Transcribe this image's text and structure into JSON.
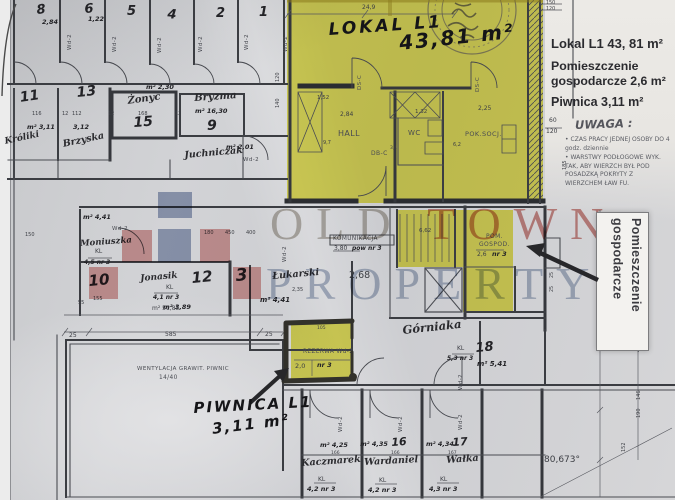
{
  "colors": {
    "highlight_yellow": "#e7e23a",
    "logo_blue": "#8696b6",
    "logo_pink": "#d98e8c",
    "watermark_red": "#b0352b",
    "watermark_blue": "#7688a8",
    "marker_black": "#151518"
  },
  "watermark": {
    "old": "OLD",
    "town": "TOWN",
    "property": "PROPERTY"
  },
  "right_panel": {
    "title": "Lokal L1 43, 81 m²",
    "line2": "Pomieszczenie",
    "line3": "gospodarcze 2,6 m²",
    "line4": "Piwnica 3,11 m²",
    "uwaga": "UWAGA :",
    "note1": "CZAS PRACY JEDNEJ OSOBY DO 4 godz. dziennie",
    "note2": "WARSTWY PODŁOGOWE WYK. TAK, ABY WIERZCH BYŁ POD POSADZKĄ POKRYTY Z WIERZCHEM ŁAW FU."
  },
  "rotated_label": {
    "line1": "Pomieszczenie",
    "line2": "gospodarcze"
  },
  "marker_notes": {
    "lokal": "LOKAL L1",
    "lokal_area": "43,81 m²",
    "piwnica": "PIWNICA L1",
    "piwnica_area": "3,11 m²"
  },
  "highlights": [
    {
      "x": 287,
      "y": 0,
      "w": 256,
      "h": 203
    },
    {
      "x": 397,
      "y": 210,
      "w": 116,
      "h": 57
    },
    {
      "x": 463,
      "y": 267,
      "w": 50,
      "h": 45
    },
    {
      "x": 291,
      "y": 323,
      "w": 61,
      "h": 57
    }
  ],
  "logo_squares": [
    {
      "x": 158,
      "y": 192,
      "w": 34,
      "h": 26,
      "c": "#8696b6"
    },
    {
      "x": 158,
      "y": 229,
      "w": 33,
      "h": 33,
      "c": "#8696b6"
    },
    {
      "x": 122,
      "y": 230,
      "w": 30,
      "h": 32,
      "c": "#d98e8c"
    },
    {
      "x": 200,
      "y": 229,
      "w": 30,
      "h": 33,
      "c": "#d98e8c"
    },
    {
      "x": 89,
      "y": 267,
      "w": 29,
      "h": 32,
      "c": "#d98e8c"
    },
    {
      "x": 233,
      "y": 267,
      "w": 28,
      "h": 32,
      "c": "#d98e8c"
    }
  ],
  "plan_labels": [
    {
      "t": "8",
      "x": 36,
      "y": 4,
      "s": 13,
      "st": "pen",
      "r": -6
    },
    {
      "t": "2,84",
      "x": 42,
      "y": 19,
      "s": 6.5,
      "st": "pen"
    },
    {
      "t": "6",
      "x": 84,
      "y": 3,
      "s": 13,
      "st": "pen",
      "r": -4
    },
    {
      "t": "1,22",
      "x": 88,
      "y": 16,
      "s": 6.5,
      "st": "pen"
    },
    {
      "t": "5",
      "x": 127,
      "y": 5,
      "s": 13,
      "st": "pen"
    },
    {
      "t": "4",
      "x": 168,
      "y": 8,
      "s": 13,
      "st": "pen",
      "r": 5
    },
    {
      "t": "2",
      "x": 216,
      "y": 7,
      "s": 13,
      "st": "pen"
    },
    {
      "t": "1",
      "x": 259,
      "y": 6,
      "s": 13,
      "st": "pen"
    },
    {
      "t": "Wd-2",
      "x": 68,
      "y": 50,
      "s": 5.5,
      "st": "tech",
      "r": -90
    },
    {
      "t": "Wd-2",
      "x": 113,
      "y": 52,
      "s": 5.5,
      "st": "tech",
      "r": -90
    },
    {
      "t": "Wd-2",
      "x": 158,
      "y": 53,
      "s": 5.5,
      "st": "tech",
      "r": -90
    },
    {
      "t": "Wd-2",
      "x": 199,
      "y": 52,
      "s": 5.5,
      "st": "tech",
      "r": -90
    },
    {
      "t": "Wd-2",
      "x": 245,
      "y": 50,
      "s": 5.5,
      "st": "tech",
      "r": -90
    },
    {
      "t": "Wd-2",
      "x": 284,
      "y": 52,
      "s": 5.5,
      "st": "tech",
      "r": -90
    },
    {
      "t": "120",
      "x": 276,
      "y": 82,
      "s": 5,
      "st": "print",
      "r": -90
    },
    {
      "t": "140",
      "x": 276,
      "y": 108,
      "s": 5,
      "st": "print",
      "r": -90
    },
    {
      "t": "11",
      "x": 19,
      "y": 91,
      "s": 14,
      "st": "pen",
      "r": -8
    },
    {
      "t": "13",
      "x": 76,
      "y": 86,
      "s": 14,
      "st": "pen",
      "r": -6
    },
    {
      "t": "m² 2,30",
      "x": 146,
      "y": 84,
      "s": 6.5,
      "st": "pen"
    },
    {
      "t": "Żonyc",
      "x": 127,
      "y": 97,
      "s": 10,
      "st": "cursive",
      "r": -8
    },
    {
      "t": "15",
      "x": 133,
      "y": 116,
      "s": 14,
      "st": "pen",
      "r": -4
    },
    {
      "t": "Bryzma",
      "x": 194,
      "y": 94,
      "s": 10,
      "st": "cursive",
      "r": -4
    },
    {
      "t": "m² 16,30",
      "x": 195,
      "y": 108,
      "s": 6.5,
      "st": "pen"
    },
    {
      "t": "9",
      "x": 207,
      "y": 119,
      "s": 14,
      "st": "pen"
    },
    {
      "t": "116",
      "x": 32,
      "y": 112,
      "s": 5,
      "st": "print"
    },
    {
      "t": "12",
      "x": 62,
      "y": 112,
      "s": 5,
      "st": "print"
    },
    {
      "t": "112",
      "x": 72,
      "y": 112,
      "s": 5,
      "st": "print"
    },
    {
      "t": "12",
      "x": 108,
      "y": 112,
      "s": 5,
      "st": "print"
    },
    {
      "t": "168",
      "x": 138,
      "y": 112,
      "s": 5,
      "st": "print"
    },
    {
      "t": "12",
      "x": 175,
      "y": 112,
      "s": 5,
      "st": "print"
    },
    {
      "t": "m² 3,11",
      "x": 27,
      "y": 124,
      "s": 6.5,
      "st": "pen"
    },
    {
      "t": "3,12",
      "x": 73,
      "y": 124,
      "s": 6.5,
      "st": "pen"
    },
    {
      "t": "Króliki",
      "x": 4,
      "y": 138,
      "s": 9,
      "st": "cursive",
      "r": -12
    },
    {
      "t": "Brzyska",
      "x": 62,
      "y": 140,
      "s": 9.5,
      "st": "cursive",
      "r": -12
    },
    {
      "t": "Juchniczak",
      "x": 184,
      "y": 151,
      "s": 9.5,
      "st": "cursive",
      "r": -5
    },
    {
      "t": "m² 2,01",
      "x": 226,
      "y": 144,
      "s": 6.5,
      "st": "pen"
    },
    {
      "t": "Wd-2",
      "x": 243,
      "y": 158,
      "s": 5.5,
      "st": "tech"
    },
    {
      "t": "24,9",
      "x": 362,
      "y": 5,
      "s": 6,
      "st": "print"
    },
    {
      "t": "HALL",
      "x": 338,
      "y": 130,
      "s": 8,
      "st": "tech"
    },
    {
      "t": "WC",
      "x": 408,
      "y": 130,
      "s": 7,
      "st": "tech"
    },
    {
      "t": "POK.SOCJ.",
      "x": 465,
      "y": 131,
      "s": 6.5,
      "st": "tech"
    },
    {
      "t": "DS-C",
      "x": 358,
      "y": 90,
      "s": 5.5,
      "st": "tech",
      "r": -90
    },
    {
      "t": "DS-C",
      "x": 476,
      "y": 92,
      "s": 5.5,
      "st": "tech",
      "r": -90
    },
    {
      "t": "DB-C",
      "x": 371,
      "y": 151,
      "s": 6,
      "st": "tech"
    },
    {
      "t": "3,4",
      "x": 390,
      "y": 147,
      "s": 4.5,
      "st": "print"
    },
    {
      "t": "1,52",
      "x": 317,
      "y": 96,
      "s": 5.5,
      "st": "print"
    },
    {
      "t": "2,84",
      "x": 340,
      "y": 112,
      "s": 6,
      "st": "print"
    },
    {
      "t": "1,32",
      "x": 415,
      "y": 110,
      "s": 5.5,
      "st": "print"
    },
    {
      "t": "2,25",
      "x": 478,
      "y": 106,
      "s": 6,
      "st": "print"
    },
    {
      "t": "9,7",
      "x": 323,
      "y": 141,
      "s": 5,
      "st": "print"
    },
    {
      "t": "6,2",
      "x": 453,
      "y": 143,
      "s": 5,
      "st": "print"
    },
    {
      "t": "KOMUNIKACJA",
      "x": 333,
      "y": 237,
      "s": 5.8,
      "st": "tech"
    },
    {
      "t": "3,80",
      "x": 334,
      "y": 246,
      "s": 6,
      "st": "print"
    },
    {
      "t": "pow nr 3",
      "x": 352,
      "y": 246,
      "s": 6,
      "st": "pen"
    },
    {
      "t": "2,68",
      "x": 349,
      "y": 271,
      "s": 9.5,
      "st": "print"
    },
    {
      "t": "6,62",
      "x": 419,
      "y": 229,
      "s": 5.5,
      "st": "print"
    },
    {
      "t": "POM.",
      "x": 486,
      "y": 234,
      "s": 6,
      "st": "tech"
    },
    {
      "t": "GOSPOD.",
      "x": 479,
      "y": 242,
      "s": 6,
      "st": "tech"
    },
    {
      "t": "2,6",
      "x": 477,
      "y": 252,
      "s": 6,
      "st": "print"
    },
    {
      "t": "nr 3",
      "x": 492,
      "y": 251,
      "s": 6.5,
      "st": "pen"
    },
    {
      "t": "Wd-2",
      "x": 283,
      "y": 262,
      "s": 5.5,
      "st": "tech",
      "r": -90
    },
    {
      "t": "180",
      "x": 204,
      "y": 231,
      "s": 5,
      "st": "print"
    },
    {
      "t": "450",
      "x": 225,
      "y": 231,
      "s": 5,
      "st": "print"
    },
    {
      "t": "400",
      "x": 246,
      "y": 231,
      "s": 5,
      "st": "print"
    },
    {
      "t": "m² 4,41",
      "x": 83,
      "y": 214,
      "s": 6.5,
      "st": "pen"
    },
    {
      "t": "Wd-2",
      "x": 112,
      "y": 227,
      "s": 5.5,
      "st": "tech"
    },
    {
      "t": "Moniuszka",
      "x": 80,
      "y": 240,
      "s": 8.5,
      "st": "cursive",
      "r": -4
    },
    {
      "t": "KL",
      "x": 95,
      "y": 249,
      "s": 6,
      "st": "print"
    },
    {
      "t": "4,5 nr 3",
      "x": 84,
      "y": 260,
      "s": 6,
      "st": "pen"
    },
    {
      "t": "10",
      "x": 88,
      "y": 274,
      "s": 15,
      "st": "pen",
      "r": -5
    },
    {
      "t": "155",
      "x": 93,
      "y": 297,
      "s": 5,
      "st": "print"
    },
    {
      "t": "55",
      "x": 78,
      "y": 301,
      "s": 5,
      "st": "print"
    },
    {
      "t": "150",
      "x": 25,
      "y": 233,
      "s": 5,
      "st": "print"
    },
    {
      "t": "12",
      "x": 191,
      "y": 271,
      "s": 15,
      "st": "pen",
      "r": -5
    },
    {
      "t": "Jonasik",
      "x": 140,
      "y": 275,
      "s": 9,
      "st": "cursive",
      "r": -5
    },
    {
      "t": "Łukarski",
      "x": 272,
      "y": 272,
      "s": 9.5,
      "st": "cursive",
      "r": -5
    },
    {
      "t": "3",
      "x": 235,
      "y": 268,
      "s": 17,
      "st": "pen",
      "r": -5
    },
    {
      "t": "KL",
      "x": 166,
      "y": 285,
      "s": 6,
      "st": "print"
    },
    {
      "t": "4,1 nr 3",
      "x": 153,
      "y": 295,
      "s": 6,
      "st": "pen"
    },
    {
      "t": "m² 3,89",
      "x": 163,
      "y": 304,
      "s": 6.5,
      "st": "pen"
    },
    {
      "t": "m² 4,41",
      "x": 260,
      "y": 297,
      "s": 7,
      "st": "pen"
    },
    {
      "t": "2,35",
      "x": 292,
      "y": 288,
      "s": 5,
      "st": "print"
    },
    {
      "t": "m² 51,85",
      "x": 152,
      "y": 306,
      "s": 6,
      "st": "print"
    },
    {
      "t": "25",
      "x": 69,
      "y": 333,
      "s": 6,
      "st": "print"
    },
    {
      "t": "585",
      "x": 165,
      "y": 332,
      "s": 6,
      "st": "print"
    },
    {
      "t": "25",
      "x": 265,
      "y": 332,
      "s": 6,
      "st": "print"
    },
    {
      "t": "WENTYLACJA GRAWIT. PIWNIC",
      "x": 137,
      "y": 367,
      "s": 5.5,
      "st": "tech"
    },
    {
      "t": "14/40",
      "x": 159,
      "y": 376,
      "s": 5.8,
      "st": "tech"
    },
    {
      "t": "105",
      "x": 317,
      "y": 327,
      "s": 4.5,
      "st": "print"
    },
    {
      "t": "REZERWA Wd-2",
      "x": 303,
      "y": 350,
      "s": 5.8,
      "st": "tech"
    },
    {
      "t": "2,0",
      "x": 295,
      "y": 363,
      "s": 6.5,
      "st": "print"
    },
    {
      "t": "nr 3",
      "x": 317,
      "y": 362,
      "s": 6.5,
      "st": "pen"
    },
    {
      "t": "Górniaka",
      "x": 402,
      "y": 325,
      "s": 11.5,
      "st": "cursive",
      "r": -6
    },
    {
      "t": "KL",
      "x": 457,
      "y": 346,
      "s": 6,
      "st": "print"
    },
    {
      "t": "5,3 nr 3",
      "x": 447,
      "y": 356,
      "s": 6,
      "st": "pen"
    },
    {
      "t": "18",
      "x": 475,
      "y": 342,
      "s": 13,
      "st": "pen",
      "r": -5
    },
    {
      "t": "m² 5,41",
      "x": 477,
      "y": 361,
      "s": 7,
      "st": "pen"
    },
    {
      "t": "Wd-2",
      "x": 459,
      "y": 390,
      "s": 5.5,
      "st": "tech",
      "r": -90
    },
    {
      "t": "m² 4,25",
      "x": 320,
      "y": 442,
      "s": 6.5,
      "st": "pen"
    },
    {
      "t": "m² 4,35",
      "x": 360,
      "y": 441,
      "s": 6.5,
      "st": "pen"
    },
    {
      "t": "16",
      "x": 391,
      "y": 437,
      "s": 11,
      "st": "pen",
      "r": -4
    },
    {
      "t": "m² 4,34",
      "x": 426,
      "y": 441,
      "s": 6.5,
      "st": "pen"
    },
    {
      "t": "17",
      "x": 452,
      "y": 437,
      "s": 11,
      "st": "pen",
      "r": -4
    },
    {
      "t": "166",
      "x": 331,
      "y": 452,
      "s": 4.5,
      "st": "print"
    },
    {
      "t": "166",
      "x": 391,
      "y": 452,
      "s": 4.5,
      "st": "print"
    },
    {
      "t": "167",
      "x": 448,
      "y": 452,
      "s": 4.5,
      "st": "print"
    },
    {
      "t": "Kaczmarek",
      "x": 301,
      "y": 459,
      "s": 9.5,
      "st": "cursive",
      "r": -4
    },
    {
      "t": "Wardaniel",
      "x": 364,
      "y": 458,
      "s": 9.5,
      "st": "cursive",
      "r": -3
    },
    {
      "t": "Wałka",
      "x": 446,
      "y": 456,
      "s": 9.5,
      "st": "cursive",
      "r": -4
    },
    {
      "t": "KL",
      "x": 318,
      "y": 477,
      "s": 6,
      "st": "print"
    },
    {
      "t": "4,2 nr 3",
      "x": 307,
      "y": 486,
      "s": 6.5,
      "st": "pen"
    },
    {
      "t": "KL",
      "x": 379,
      "y": 478,
      "s": 6,
      "st": "print"
    },
    {
      "t": "4,2 nr 3",
      "x": 368,
      "y": 487,
      "s": 6.5,
      "st": "pen"
    },
    {
      "t": "KL",
      "x": 440,
      "y": 477,
      "s": 6,
      "st": "print"
    },
    {
      "t": "4,3 nr 3",
      "x": 429,
      "y": 486,
      "s": 6.5,
      "st": "pen"
    },
    {
      "t": "Wd-2",
      "x": 339,
      "y": 432,
      "s": 5.5,
      "st": "tech",
      "r": -90
    },
    {
      "t": "Wd-2",
      "x": 399,
      "y": 432,
      "s": 5.5,
      "st": "tech",
      "r": -90
    },
    {
      "t": "Wd-2",
      "x": 459,
      "y": 430,
      "s": 5.5,
      "st": "tech",
      "r": -90
    },
    {
      "t": "150",
      "x": 546,
      "y": 2,
      "s": 4.8,
      "st": "print"
    },
    {
      "t": "120",
      "x": 546,
      "y": 8,
      "s": 4.8,
      "st": "print"
    },
    {
      "t": "60",
      "x": 549,
      "y": 118,
      "s": 6,
      "st": "print"
    },
    {
      "t": "120",
      "x": 546,
      "y": 129,
      "s": 6,
      "st": "print"
    },
    {
      "t": "185",
      "x": 563,
      "y": 170,
      "s": 5,
      "st": "print",
      "r": -90
    },
    {
      "t": "454",
      "x": 637,
      "y": 352,
      "s": 5,
      "st": "print",
      "r": -90
    },
    {
      "t": "146",
      "x": 637,
      "y": 400,
      "s": 5,
      "st": "print",
      "r": -90
    },
    {
      "t": "190",
      "x": 637,
      "y": 418,
      "s": 5,
      "st": "print",
      "r": -90
    },
    {
      "t": "152",
      "x": 622,
      "y": 452,
      "s": 5,
      "st": "print",
      "r": -90
    },
    {
      "t": "25",
      "x": 551,
      "y": 278,
      "s": 4.8,
      "st": "print",
      "r": -90
    },
    {
      "t": "25",
      "x": 551,
      "y": 292,
      "s": 4.8,
      "st": "print",
      "r": -90
    },
    {
      "t": "80,673°",
      "x": 544,
      "y": 456,
      "s": 9,
      "st": "print"
    }
  ]
}
